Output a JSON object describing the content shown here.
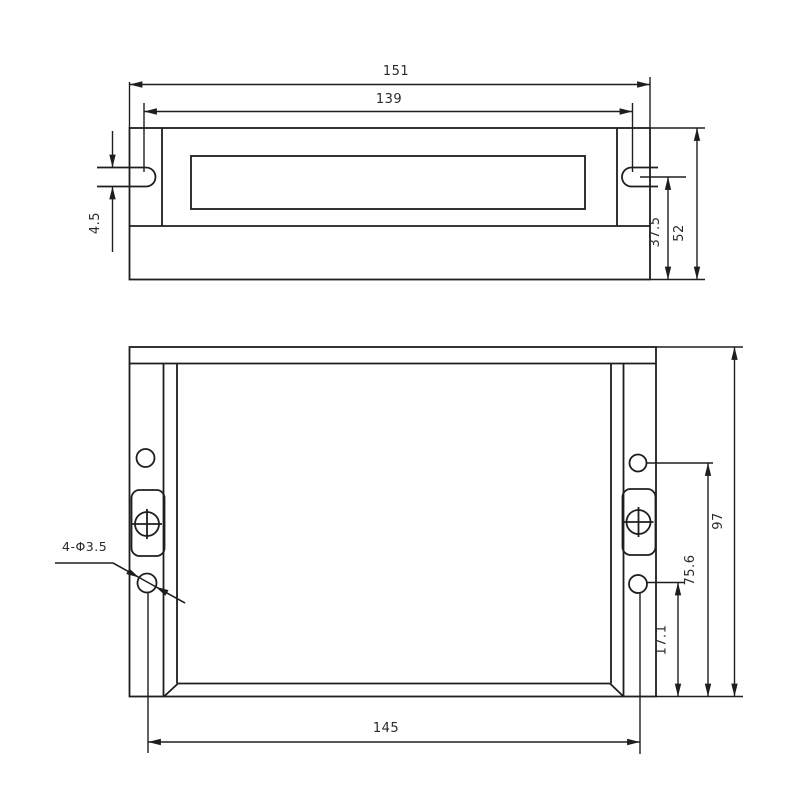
{
  "drawing": {
    "type": "technical-dimension-drawing",
    "background_color": "#ffffff",
    "line_color": "#1e1e1e",
    "text_color": "#2a2a2a",
    "top_view": {
      "dim_overall_width": "151",
      "dim_slot_center_spacing": "139",
      "dim_slot_width": "4.5",
      "dim_body_depth": "37.5",
      "dim_overall_depth": "52"
    },
    "front_view": {
      "dim_overall_height": "97",
      "dim_upper_hole_to_base": "75.6",
      "dim_lower_hole_to_base": "17.1",
      "dim_hole_spacing_horizontal": "145",
      "hole_callout": "4-Φ3.5"
    }
  }
}
